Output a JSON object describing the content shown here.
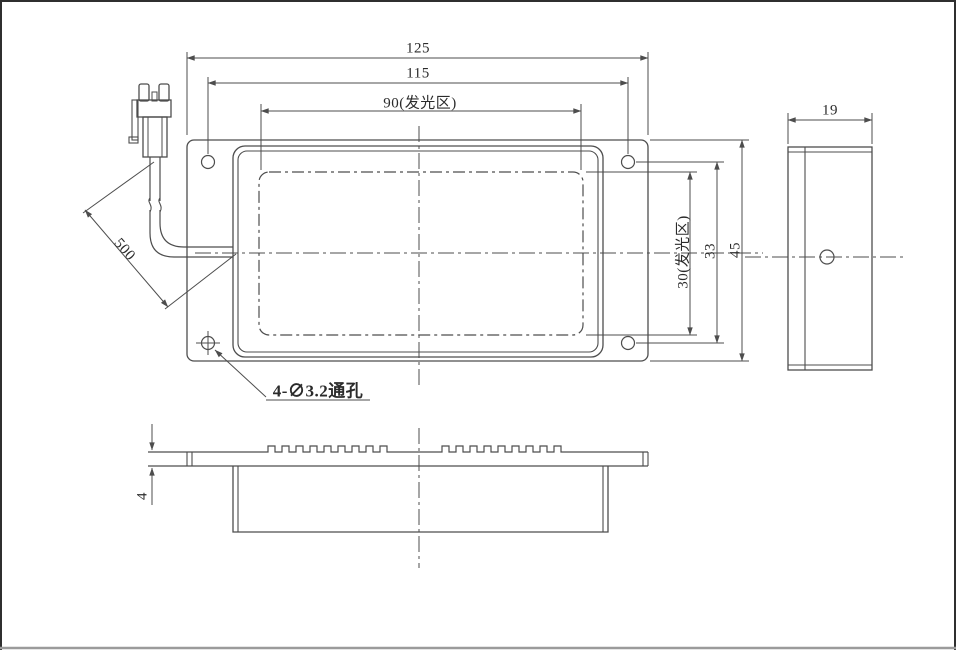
{
  "page": {
    "background": "#ffffff",
    "line_color": "#4d4d4d",
    "text_color": "#2b2b2b"
  },
  "top_view": {
    "dim_overall_width": "125",
    "dim_hole_span_width": "115",
    "dim_luminous_width": "90(发光区)",
    "dim_luminous_height": "30(发光区)",
    "dim_hole_span_height": "33",
    "dim_overall_height": "45",
    "hole_callout": "4-∅3.2通孔",
    "dim_cable_length": "500"
  },
  "side_view": {
    "dim_depth": "19"
  },
  "section_view": {
    "dim_plate_thickness": "4"
  }
}
